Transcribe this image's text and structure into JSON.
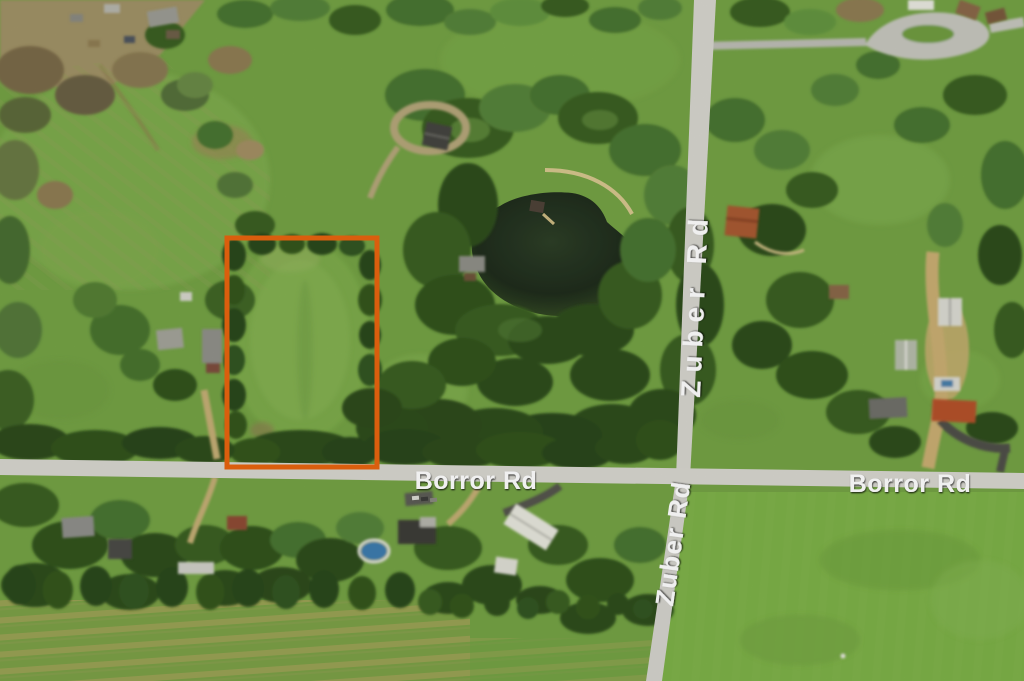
{
  "view": {
    "labels": {
      "borror_west": "Borror Rd",
      "borror_east": "Borror Rd",
      "zuber_north": "Zuber Rd",
      "zuber_south": "Zuber Rd"
    },
    "highlight": {
      "color": "#E8640E"
    },
    "palette": {
      "grass": "#74A245",
      "tree_dark": "#32511D",
      "road": "#D7D6CF",
      "water": "#222E1D",
      "dirt_path": "#C9B278"
    }
  }
}
